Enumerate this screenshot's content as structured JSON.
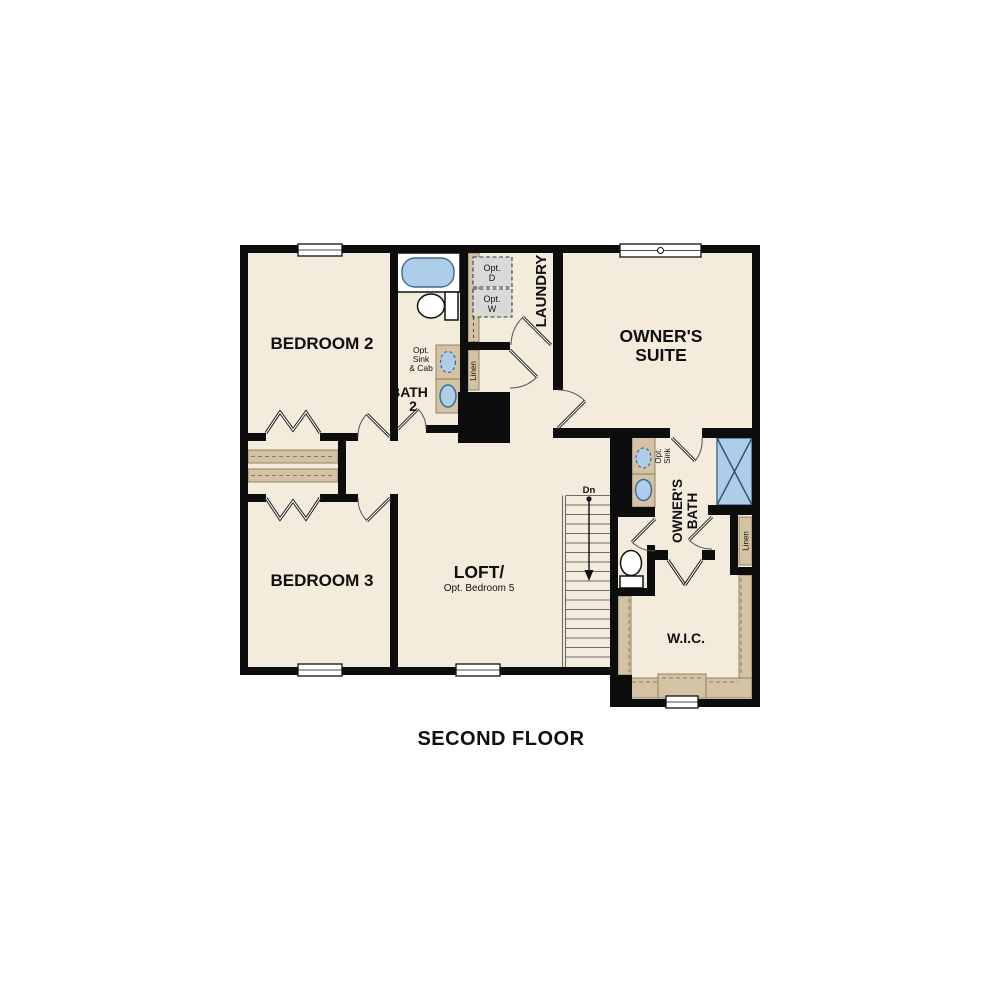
{
  "title": "SECOND FLOOR",
  "rooms": {
    "bedroom2": "BEDROOM 2",
    "bedroom3": "BEDROOM 3",
    "owners_suite": {
      "line1": "OWNER'S",
      "line2": "SUITE"
    },
    "loft": {
      "line1": "LOFT/",
      "line2": "Opt. Bedroom 5"
    },
    "wic": "W.I.C.",
    "bath2": {
      "line1": "BATH",
      "line2": "2"
    },
    "laundry": "LAUNDRY",
    "owners_bath": {
      "line1": "OWNER'S",
      "line2": "BATH"
    }
  },
  "annotations": {
    "opt_sink_cab": {
      "line1": "Opt.",
      "line2": "Sink",
      "line3": "& Cab"
    },
    "opt_sink": {
      "line1": "Opt.",
      "line2": "Sink"
    },
    "opt_dryer": {
      "line1": "Opt.",
      "line2": "D"
    },
    "opt_washer": {
      "line1": "Opt.",
      "line2": "W"
    },
    "linen_bath": "Linen",
    "linen_owners": "Linen",
    "stairs_dn": "Dn"
  },
  "colors": {
    "floor": "#f3ecdc",
    "wall": "#0d0d0d",
    "shelf": "#d3c2a4",
    "shelf_line": "#8b7a5c",
    "fixture": "#aecde9",
    "fixture_line": "#3f678c",
    "appliance": "#d9d9d9"
  }
}
